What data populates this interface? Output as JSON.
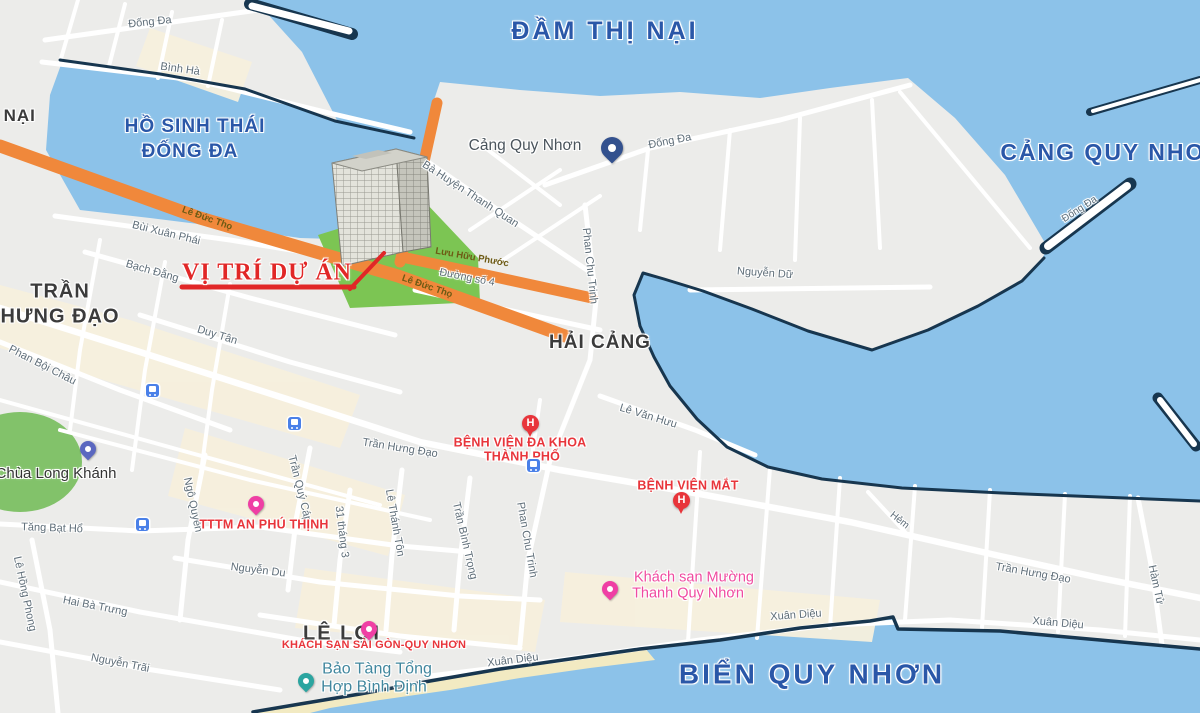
{
  "colors": {
    "water": "#8CC2E9",
    "land": "#ECECEA",
    "road_highlight_orange": "#F0883B",
    "beige_block": "#F7F0DD",
    "park_green": "#82C26A",
    "parcel_green": "#7CC553",
    "shoreline_dark": "#17364F",
    "water_label_blue": "#2A57A8",
    "street_label_gray": "#5F6E79",
    "poi_red": "#E8353B",
    "poi_pink": "#F04BA0",
    "poi_teal": "#41879E",
    "callout_red": "#E12727",
    "sand": "#F2EAC2"
  },
  "water_labels": {
    "dam_thi_nai": "ĐẦM THỊ NẠI",
    "ho_sinh_thai_1": "HỒ SINH THÁI",
    "ho_sinh_thai_2": "ĐỐNG ĐA",
    "cang_quy_nhon": "CẢNG QUY NHƠN",
    "bien_quy_nhon": "BIỂN QUY NHƠN"
  },
  "district_labels": {
    "nai_partial": "Ị NẠI",
    "tran_1": "TRẦN",
    "tran_2": "HƯNG ĐẠO",
    "le_loi": "LÊ LỢI",
    "hai_cang": "HẢI CẢNG"
  },
  "callout": {
    "project_location": "VỊ TRÍ DỰ ÁN"
  },
  "streets": {
    "dong_da": "Đống Đa",
    "binh_ha": "Bình Hà",
    "bui_xuan_phai": "Bùi Xuân Phái",
    "bach_dang": "Bạch Đằng",
    "le_duc_tho": "Lê Đức Thọ",
    "luu_huu_phuoc": "Lưu Hữu Phước",
    "duong_so_4": "Đường số 4",
    "ba_huyen_thanh_quan": "Bà Huyện Thanh Quan",
    "phan_chu_trinh": "Phan Chu Trinh",
    "nguyen_du_2": "Nguyễn Dữ",
    "duy_tan": "Duy Tân",
    "phan_boi_chau": "Phan Bội Châu",
    "tang_bat_ho": "Tăng Bạt Hổ",
    "le_hong_phong": "Lê Hồng Phong",
    "hai_ba_trung": "Hai Bà Trưng",
    "nguyen_trai": "Nguyễn Trãi",
    "ngo_quyen": "Ngô Quyền",
    "tran_quy_cap": "Trần Quý Cáp",
    "ba_muoi_mot_thang_3": "31 tháng 3",
    "le_thanh_ton": "Lê Thánh Tôn",
    "tran_binh_trong": "Trần Bình Trọng",
    "nguyen_du": "Nguyễn Du",
    "tran_hung_dao": "Trần Hưng Đạo",
    "le_van_huu": "Lê Văn Hưu",
    "xuan_dieu": "Xuân Diệu",
    "ham_tu": "Hàm Tử",
    "hem": "Hẻm"
  },
  "pois": {
    "cang_quy_nhon": "Cảng Quy Nhơn",
    "benh_vien_da_khoa_1": "BỆNH VIỆN ĐA KHOA",
    "benh_vien_da_khoa_2": "THÀNH PHỐ",
    "benh_vien_mat": "BỆNH VIỆN MẮT",
    "hospital_glyph": "H",
    "tttm": "TTTM AN PHÚ THỊNH",
    "ks_sai_gon": "KHÁCH SẠN SÀI GÒN-QUY NHƠN",
    "muong_thanh_1": "Khách sạn Mường",
    "muong_thanh_2": "Thanh Quy Nhơn",
    "bao_tang_1": "Bảo Tàng Tổng",
    "bao_tang_2": "Hợp Bình Định",
    "chua_long_khanh": "Chùa Long Khánh"
  }
}
